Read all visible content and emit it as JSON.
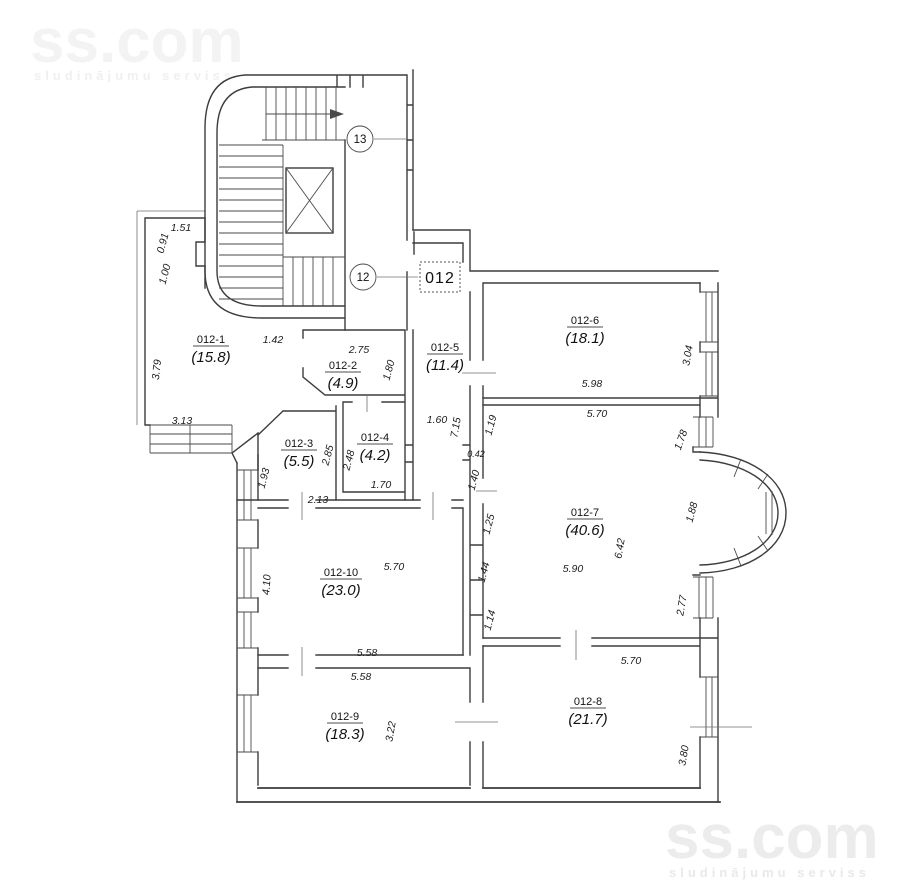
{
  "watermark": {
    "brand": "ss.com",
    "tagline": "sludinājumu serviss"
  },
  "markers": {
    "floor_upper": "13",
    "floor_lower": "12",
    "unit": "012"
  },
  "rooms": [
    {
      "id": "012-1",
      "area": "(15.8)"
    },
    {
      "id": "012-2",
      "area": "(4.9)"
    },
    {
      "id": "012-3",
      "area": "(5.5)"
    },
    {
      "id": "012-4",
      "area": "(4.2)"
    },
    {
      "id": "012-5",
      "area": "(11.4)"
    },
    {
      "id": "012-6",
      "area": "(18.1)"
    },
    {
      "id": "012-7",
      "area": "(40.6)"
    },
    {
      "id": "012-8",
      "area": "(21.7)"
    },
    {
      "id": "012-9",
      "area": "(18.3)"
    },
    {
      "id": "012-10",
      "area": "(23.0)"
    }
  ],
  "dims": [
    "1.51",
    "0.91",
    "1.00",
    "3.79",
    "3.13",
    "1.42",
    "2.75",
    "1.80",
    "2.85",
    "2.48",
    "1.70",
    "2.13",
    "1.93",
    "1.60",
    "7.15",
    "0.42",
    "1.40",
    "1.19",
    "5.98",
    "3.04",
    "5.70",
    "1.78",
    "1.88",
    "6.42",
    "5.90",
    "1.25",
    "1.44",
    "1.14",
    "2.77",
    "4.10",
    "5.70",
    "5.58",
    "5.58",
    "3.22",
    "5.70",
    "3.80"
  ]
}
